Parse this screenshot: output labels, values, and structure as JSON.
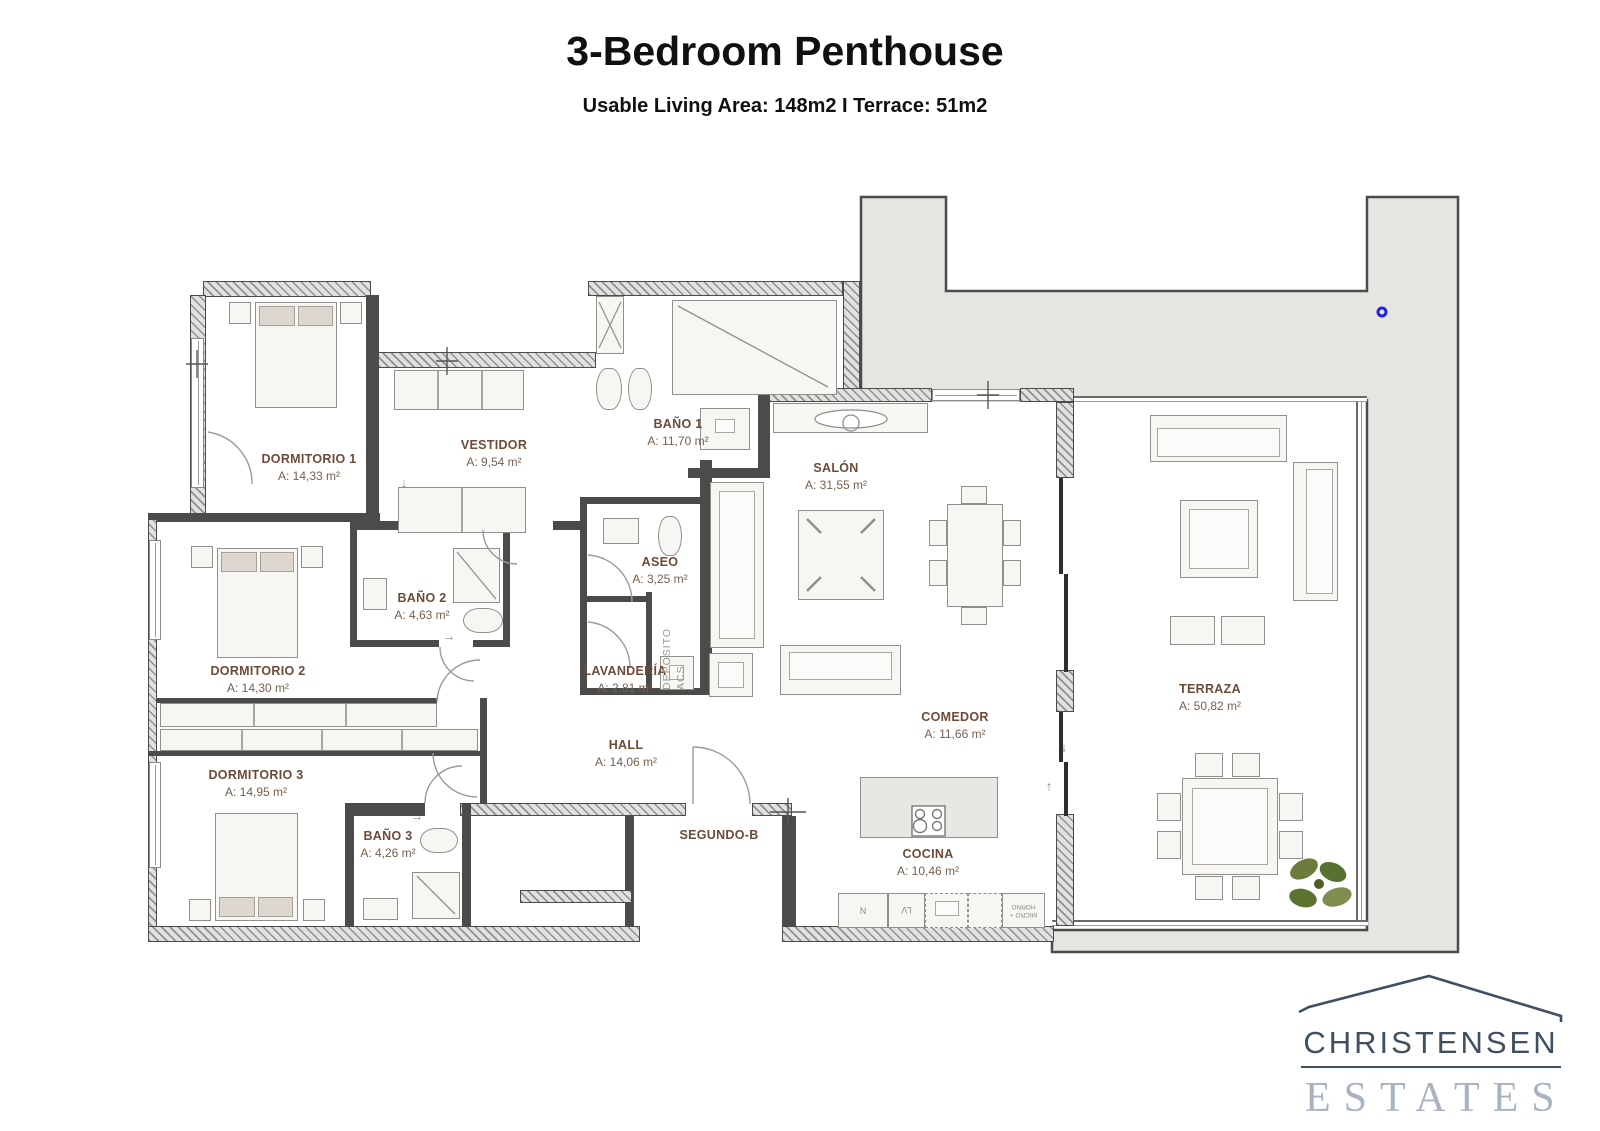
{
  "header": {
    "title": "3-Bedroom Penthouse",
    "subtitle": "Usable Living Area: 148m2 I Terrace: 51m2"
  },
  "rooms": [
    {
      "name": "DORMITORIO 1",
      "area": "A: 14,33 m²"
    },
    {
      "name": "VESTIDOR",
      "area": "A: 9,54 m²"
    },
    {
      "name": "BAÑO 1",
      "area": "A: 11,70 m²"
    },
    {
      "name": "SALÓN",
      "area": "A: 31,55 m²"
    },
    {
      "name": "DORMITORIO 2",
      "area": "A: 14,30 m²"
    },
    {
      "name": "BAÑO 2",
      "area": "A: 4,63 m²"
    },
    {
      "name": "ASEO",
      "area": "A: 3,25 m²"
    },
    {
      "name": "LAVANDERÍA",
      "area": "A: 2,81 m²"
    },
    {
      "name": "DORMITORIO 3",
      "area": "A: 14,95 m²"
    },
    {
      "name": "BAÑO 3",
      "area": "A: 4,26 m²"
    },
    {
      "name": "HALL",
      "area": "A: 14,06 m²"
    },
    {
      "name": "COMEDOR",
      "area": "A: 11,66 m²"
    },
    {
      "name": "COCINA",
      "area": "A: 10,46 m²"
    },
    {
      "name": "TERRAZA",
      "area": "A: 50,82 m²"
    }
  ],
  "plan": {
    "unit_label": "SEGUNDO-B",
    "utility_line1": "DEPOSITO",
    "utility_line2": "ACS",
    "kitchen": {
      "fridge": "N",
      "dishwasher": "LV",
      "oven": "MICRO + HORNO"
    },
    "arrows": {
      "down": "↓",
      "right": "→",
      "up": "↑"
    }
  },
  "logo": {
    "line1": "CHRISTENSEN",
    "line2": "ESTATES"
  },
  "colors": {
    "room_label": "#6d4b39",
    "plan_gray": "#e6e5e2",
    "wall_dark": "#4b4b49",
    "marker_blue": "#2323dd",
    "logo_dark": "#3f5061",
    "logo_light": "#a8b3bf",
    "plant_green": "#6c7c3c"
  }
}
